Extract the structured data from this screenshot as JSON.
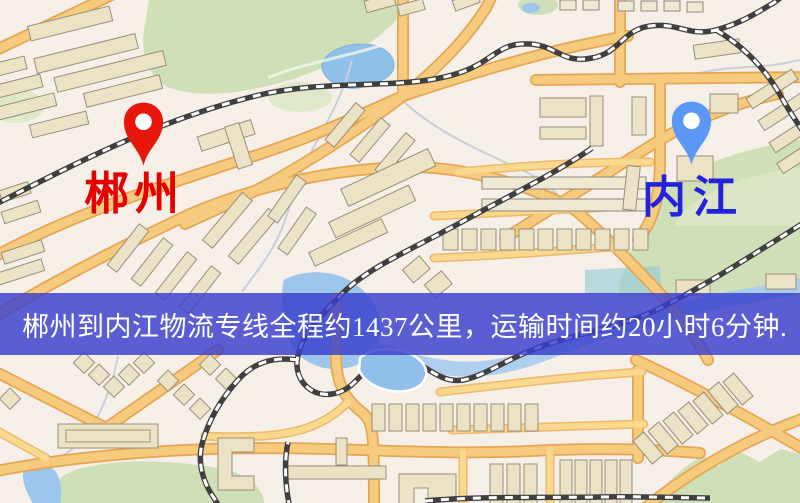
{
  "map": {
    "origin": {
      "label": "郴州",
      "pin_icon": "red-map-pin",
      "pin_color": "#e8170c",
      "label_color": "#e60000"
    },
    "destination": {
      "label": "内江",
      "pin_icon": "blue-map-pin",
      "pin_color": "#5b97f7",
      "label_color": "#2222dd"
    },
    "banner": {
      "text": "郴州到内江物流专线全程约1437公里，运输时间约20小时6分钟.",
      "background_color": "#3a3ecd",
      "text_color": "#ffffff"
    },
    "style_colors": {
      "background": "#f5efe8",
      "road_fill": "#f7cb7e",
      "road_casing": "#e5a654",
      "park": "#cfdfb8",
      "water": "#9cc6ec",
      "building": "#ece3c6",
      "railway": "#3f3f3f"
    }
  }
}
